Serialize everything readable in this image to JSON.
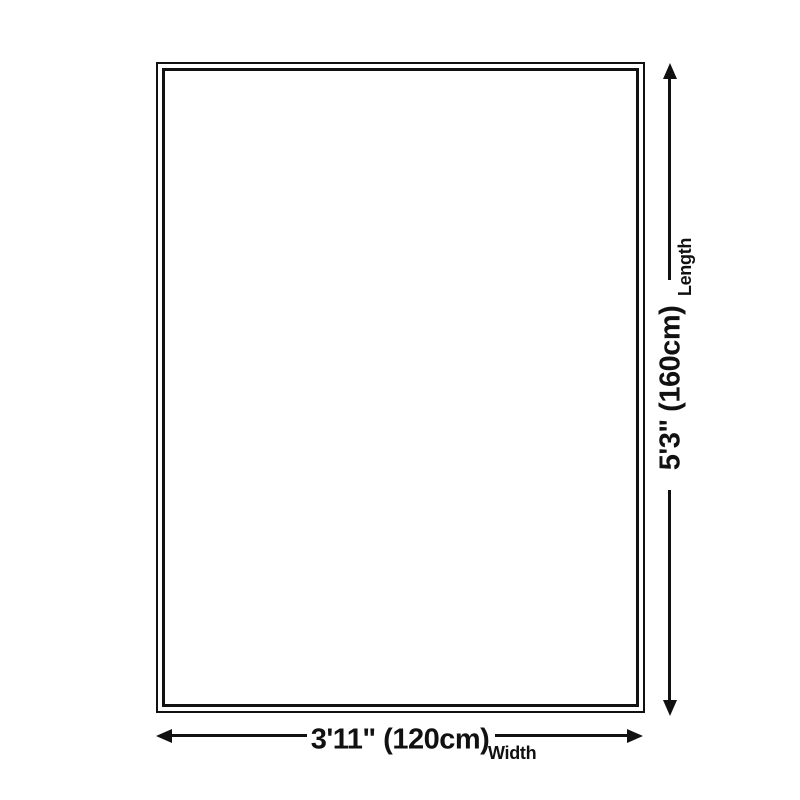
{
  "diagram": {
    "type": "product-size-diagram",
    "background_color": "#ffffff",
    "line_color": "#111111",
    "dimensions": {
      "length": {
        "label": "Length",
        "value": "5'3\" (160cm)"
      },
      "width": {
        "label": "Width",
        "value": "3'11\" (120cm)"
      }
    }
  }
}
